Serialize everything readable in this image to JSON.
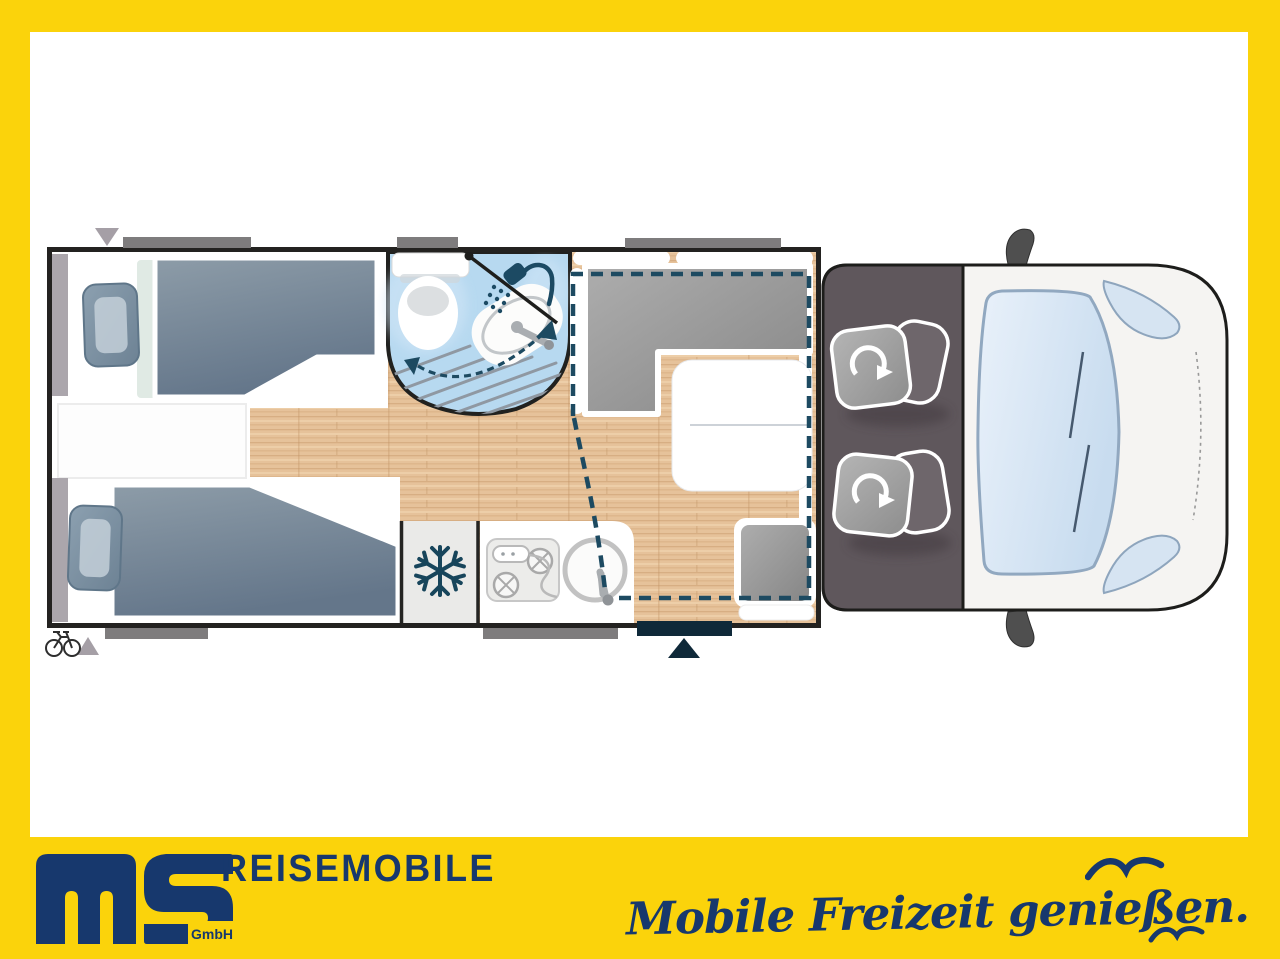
{
  "frame": {
    "border_color": "#fbd30b",
    "canvas_color": "#ffffff"
  },
  "footer": {
    "logo": {
      "letters": "ms",
      "suffix": "GmbH",
      "color": "#17386d"
    },
    "brand": "REISEMOBILE",
    "tagline": "Mobile Freizeit genießen.",
    "icons": [
      "seagull-icon-large",
      "seagull-icon-small"
    ],
    "text_color": "#17386d"
  },
  "floorplan": {
    "type": "motorhome-top-view",
    "areas": [
      "single-bed-top",
      "single-bed-bottom",
      "wardrobe-strips",
      "bathroom-with-toilet-and-shower",
      "fridge",
      "kitchen-with-hob-and-sink",
      "dinette-l-bench",
      "dinette-table",
      "side-bench",
      "drop-down-bed-dashed-outline",
      "entry-door",
      "cab-with-swivel-seats",
      "vehicle-front"
    ],
    "icons": [
      "snowflake-icon",
      "shower-head-icon",
      "bicycle-icon",
      "rotation-arrow-icon",
      "entry-arrow-icon",
      "marker-triangle-icon",
      "side-mirror-icon"
    ],
    "colors": {
      "wood_floor": "#e6c29a",
      "bathroom_blue": "#b7d9f0",
      "mattress": "#74838f",
      "seat_gray": "#9b9b9b",
      "cab_gray": "#5f575c",
      "dashed_line": "#1d4a61",
      "entry_navy": "#0f2939",
      "wall": "#232220",
      "window_bar_gray": "#7e7c7d"
    }
  }
}
